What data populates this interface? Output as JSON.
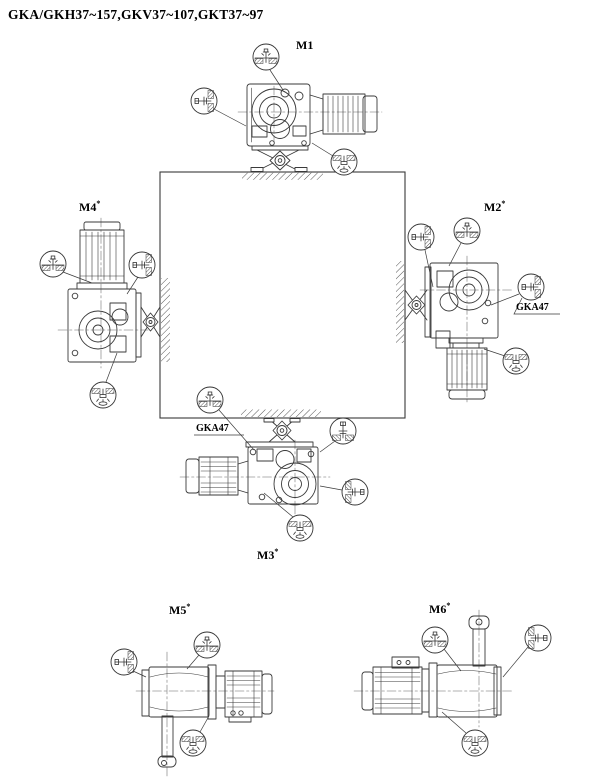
{
  "title": "GKA/GKH37~157,GKV37~107,GKT37~97",
  "colors": {
    "background": "#ffffff",
    "line": "#3a3a3a",
    "text": "#000000"
  },
  "views": {
    "m1": {
      "label": "M1",
      "sup": ""
    },
    "m2": {
      "label": "M2",
      "sup": "*",
      "note": "GKA47"
    },
    "m3": {
      "label": "M3",
      "sup": "*",
      "note": "GKA47"
    },
    "m4": {
      "label": "M4",
      "sup": "*"
    },
    "m5": {
      "label": "M5",
      "sup": "*"
    },
    "m6": {
      "label": "M6",
      "sup": "*"
    }
  },
  "icons": {
    "breather": "breather-plug-icon",
    "oil_level": "oil-level-plug-icon",
    "oil_drain": "oil-drain-plug-icon"
  }
}
